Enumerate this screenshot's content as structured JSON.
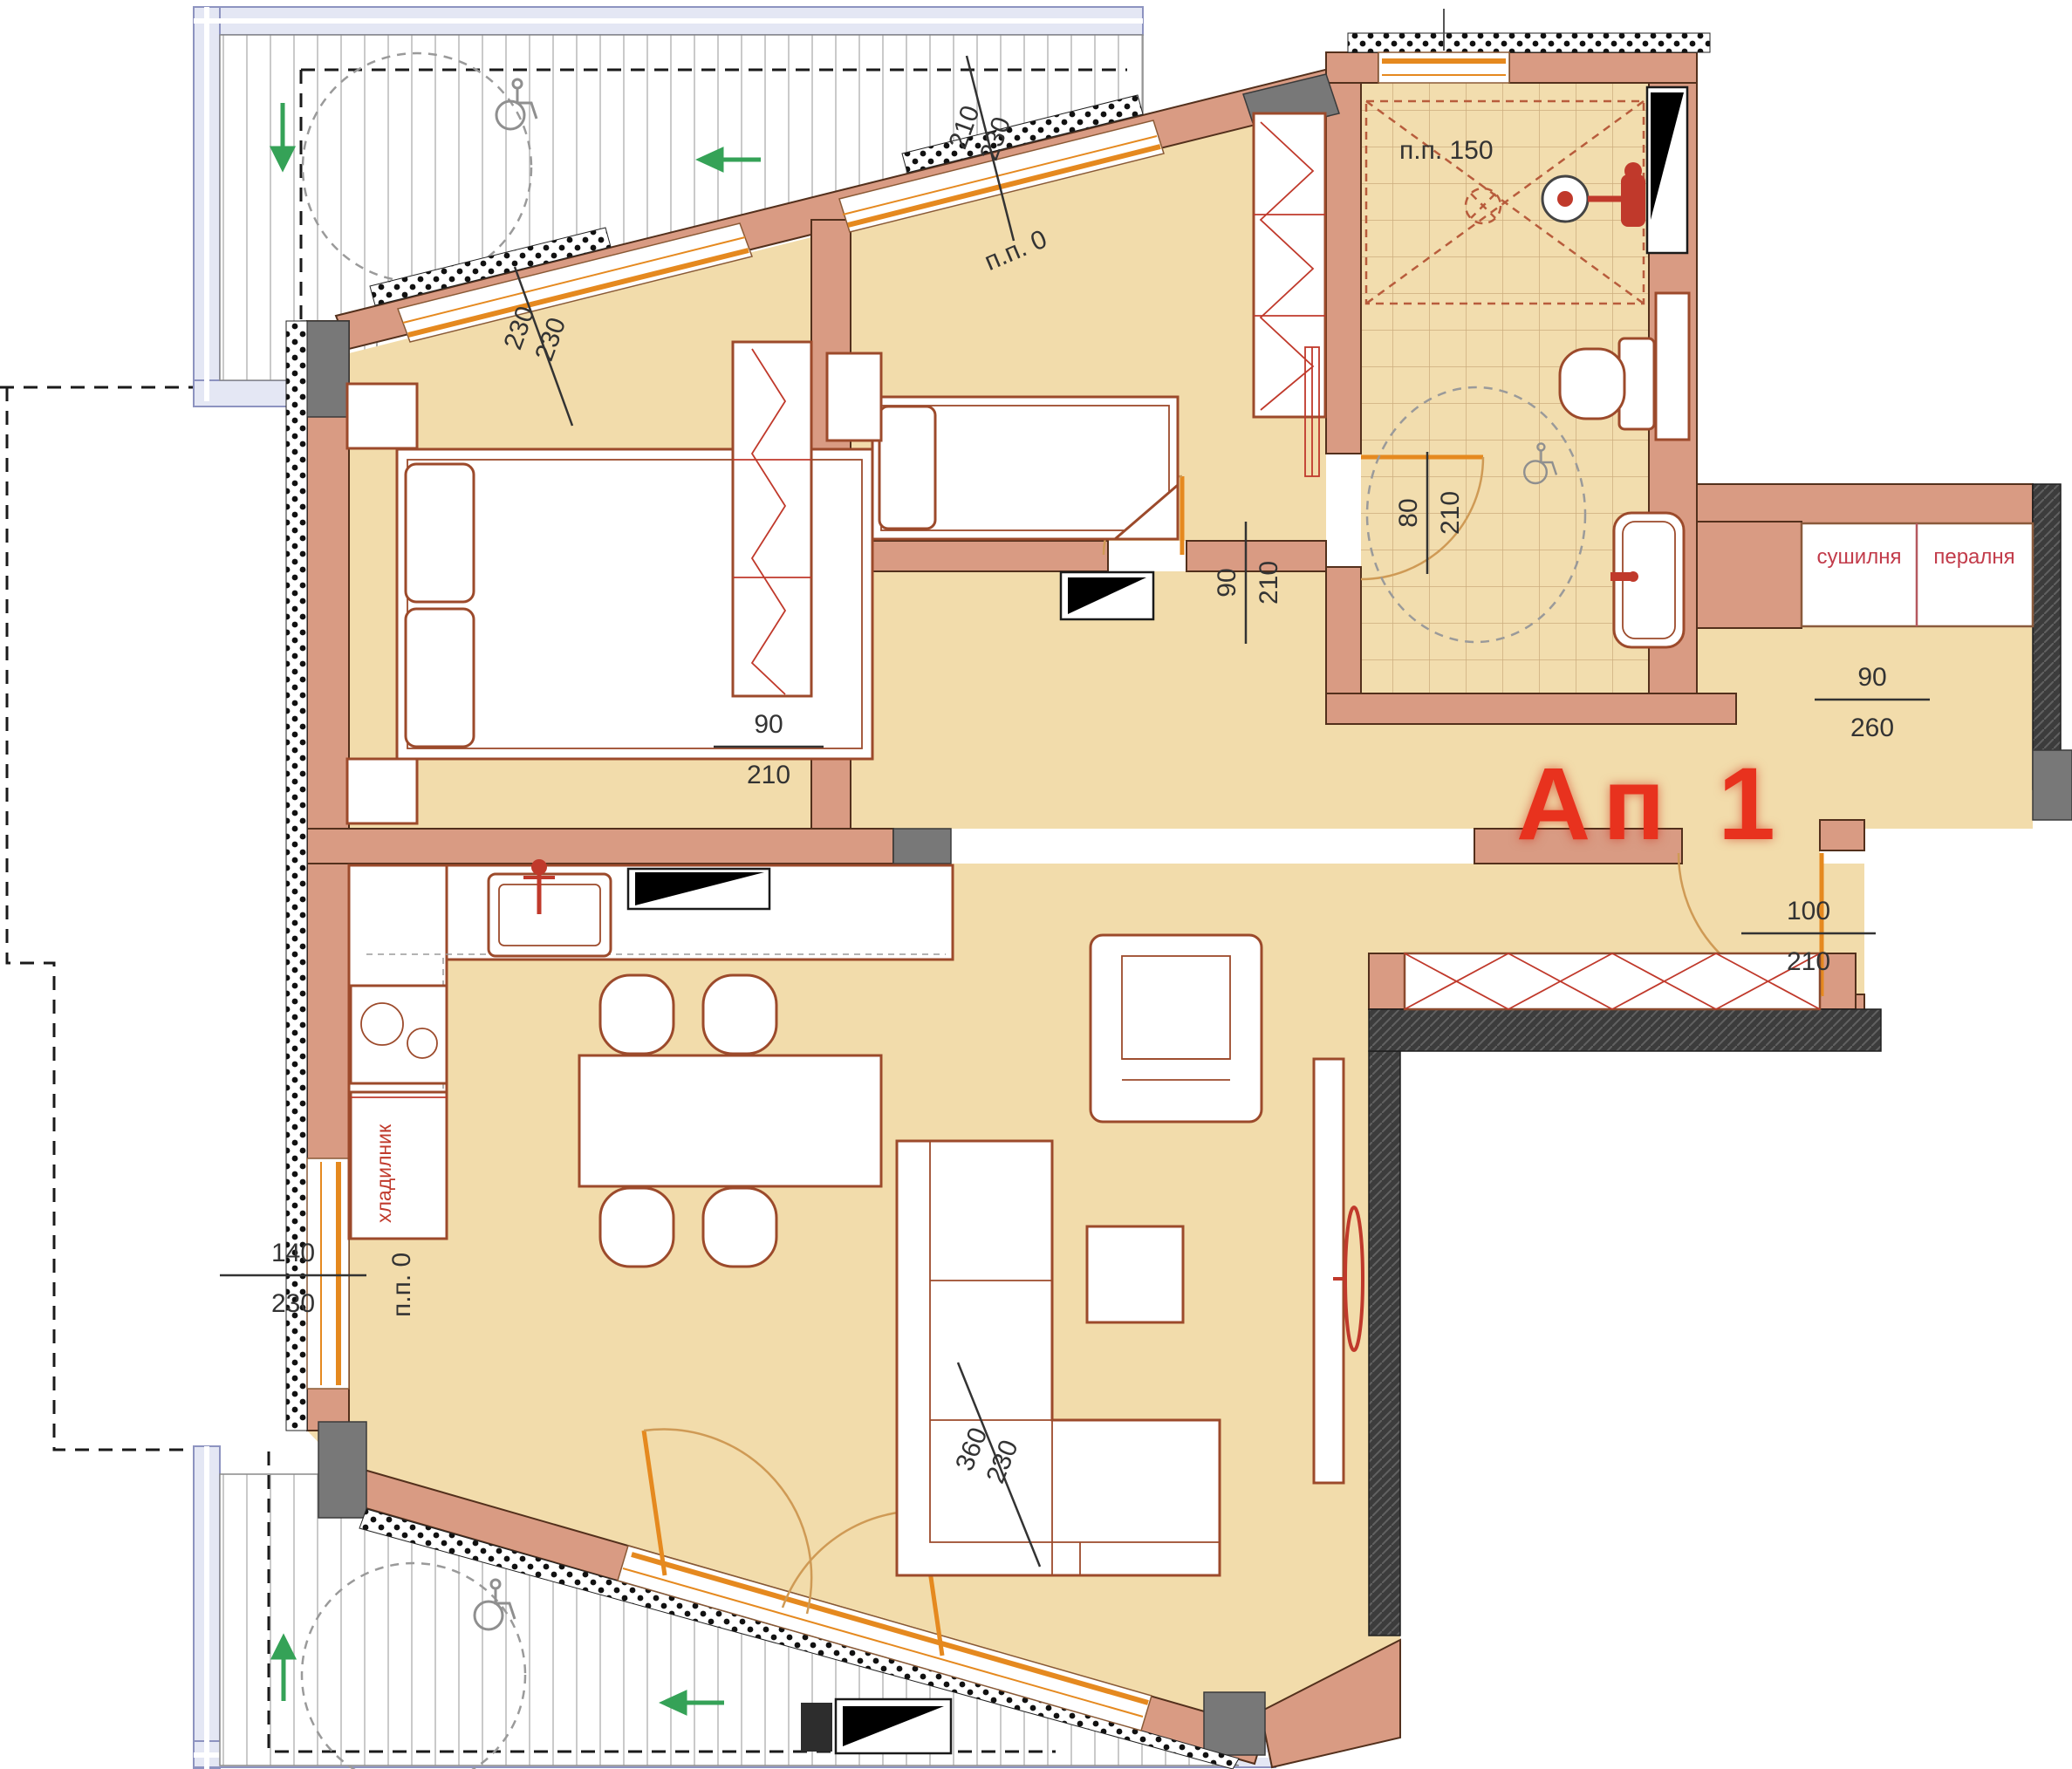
{
  "labels": {
    "apartment": "Ап 1",
    "pp0_top": "п.п. 0",
    "pp0_left": "п.п. 0",
    "pp150": "п.п. 150",
    "dryer": "сушилня",
    "washer": "пералня",
    "fridge": "хладилник"
  },
  "dimensions": {
    "bedroom1_window": {
      "top": "230",
      "bottom": "230"
    },
    "bedroom2_window": {
      "top": "210",
      "bottom": "230"
    },
    "bedroom1_door": {
      "top": "90",
      "bottom": "210"
    },
    "bedroom2_door": {
      "top": "90",
      "bottom": "210"
    },
    "bathroom_door": {
      "top": "80",
      "bottom": "210"
    },
    "hall_passage": {
      "top": "90",
      "bottom": "260"
    },
    "entrance_door": {
      "top": "100",
      "bottom": "210"
    },
    "living_window_left": {
      "top": "140",
      "bottom": "230"
    },
    "terrace_door": {
      "top": "360",
      "bottom": "230"
    }
  },
  "colors": {
    "wall": "#d99b83",
    "floor": "#f2dcab",
    "accent_red": "#e8321e",
    "window_orange": "#e5891f",
    "dimension_text": "#333333"
  }
}
